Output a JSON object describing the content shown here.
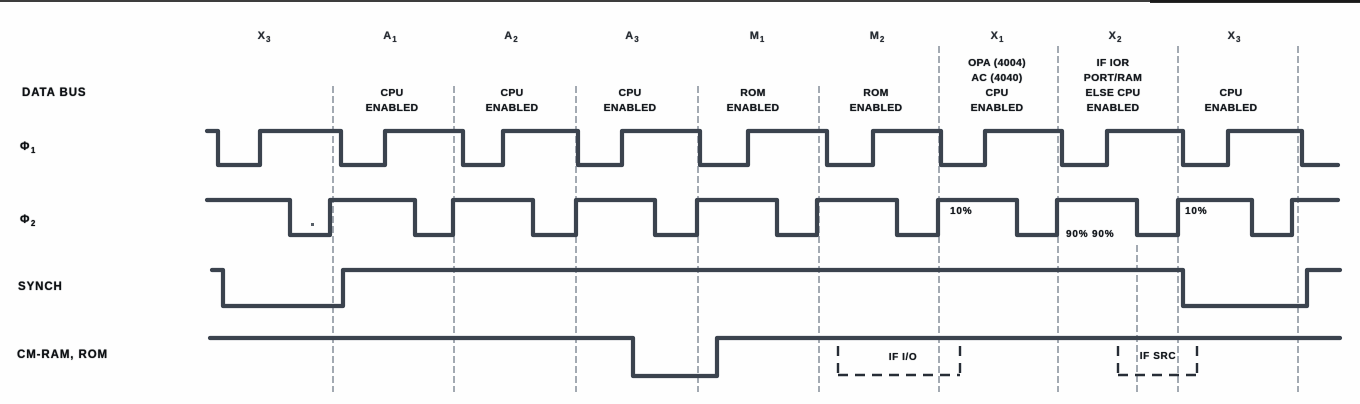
{
  "canvas": {
    "width": 1360,
    "height": 404
  },
  "colors": {
    "ink": "#3b434e",
    "grid": "#5c6878",
    "window": "#272d36",
    "text": "#14181d",
    "background": "#fefefe"
  },
  "phase_labels": [
    {
      "base": "X",
      "sub": "3",
      "x": 264,
      "y": 30
    },
    {
      "base": "A",
      "sub": "1",
      "x": 390,
      "y": 30
    },
    {
      "base": "A",
      "sub": "2",
      "x": 511,
      "y": 30
    },
    {
      "base": "A",
      "sub": "3",
      "x": 632,
      "y": 30
    },
    {
      "base": "M",
      "sub": "1",
      "x": 757,
      "y": 30
    },
    {
      "base": "M",
      "sub": "2",
      "x": 877,
      "y": 30
    },
    {
      "base": "X",
      "sub": "1",
      "x": 997,
      "y": 30
    },
    {
      "base": "X",
      "sub": "2",
      "x": 1115,
      "y": 30
    },
    {
      "base": "X",
      "sub": "3",
      "x": 1234,
      "y": 30
    }
  ],
  "row_labels": [
    {
      "name": "data-bus-label",
      "text": "DATA BUS",
      "x": 22,
      "y": 87
    },
    {
      "name": "phi1-label",
      "base": "Φ",
      "sub": "1",
      "x": 20,
      "y": 141
    },
    {
      "name": "phi2-label",
      "base": "Φ",
      "sub": "2",
      "x": 20,
      "y": 214
    },
    {
      "name": "synch-label",
      "text": "SYNCH",
      "x": 18,
      "y": 281
    },
    {
      "name": "cm-ram-rom-label",
      "text": "CM-RAM, ROM",
      "x": 17,
      "y": 349
    }
  ],
  "bus_annotations": [
    {
      "lines": [
        "CPU",
        "ENABLED"
      ],
      "x": 392,
      "y": 86
    },
    {
      "lines": [
        "CPU",
        "ENABLED"
      ],
      "x": 512,
      "y": 86
    },
    {
      "lines": [
        "CPU",
        "ENABLED"
      ],
      "x": 630,
      "y": 86
    },
    {
      "lines": [
        "ROM",
        "ENABLED"
      ],
      "x": 753,
      "y": 86
    },
    {
      "lines": [
        "ROM",
        "ENABLED"
      ],
      "x": 876,
      "y": 86
    },
    {
      "lines": [
        "OPA (4004)",
        "AC (4040)",
        "CPU",
        "ENABLED"
      ],
      "x": 997,
      "y": 56
    },
    {
      "lines": [
        "IF IOR",
        "PORT/RAM",
        "ELSE CPU",
        "ENABLED"
      ],
      "x": 1113,
      "y": 56
    },
    {
      "lines": [
        "CPU",
        "ENABLED"
      ],
      "x": 1231,
      "y": 86
    }
  ],
  "grid": {
    "y_bottom": 392,
    "lines": [
      {
        "x": 333,
        "y1": 86
      },
      {
        "x": 454,
        "y1": 86
      },
      {
        "x": 576,
        "y1": 86
      },
      {
        "x": 698,
        "y1": 86
      },
      {
        "x": 819,
        "y1": 86
      },
      {
        "x": 939,
        "y1": 46
      },
      {
        "x": 1058,
        "y1": 46
      },
      {
        "x": 1178,
        "y1": 46
      },
      {
        "x": 1298,
        "y1": 46
      }
    ],
    "short_line": {
      "x": 1137,
      "y1": 245,
      "y2": 392
    }
  },
  "signals": [
    {
      "id": "phi1",
      "high_y": 131,
      "low_y": 165,
      "points": [
        [
          207,
          "H"
        ],
        [
          218,
          "H"
        ],
        [
          218,
          "L"
        ],
        [
          260,
          "L"
        ],
        [
          260,
          "H"
        ],
        [
          341,
          "H"
        ],
        [
          341,
          "L"
        ],
        [
          385,
          "L"
        ],
        [
          385,
          "H"
        ],
        [
          463,
          "H"
        ],
        [
          463,
          "L"
        ],
        [
          503,
          "L"
        ],
        [
          503,
          "H"
        ],
        [
          578,
          "H"
        ],
        [
          578,
          "L"
        ],
        [
          622,
          "L"
        ],
        [
          622,
          "H"
        ],
        [
          700,
          "H"
        ],
        [
          700,
          "L"
        ],
        [
          748,
          "L"
        ],
        [
          748,
          "H"
        ],
        [
          827,
          "H"
        ],
        [
          827,
          "L"
        ],
        [
          873,
          "L"
        ],
        [
          873,
          "H"
        ],
        [
          941,
          "H"
        ],
        [
          941,
          "L"
        ],
        [
          985,
          "L"
        ],
        [
          985,
          "H"
        ],
        [
          1062,
          "H"
        ],
        [
          1062,
          "L"
        ],
        [
          1107,
          "L"
        ],
        [
          1107,
          "H"
        ],
        [
          1183,
          "H"
        ],
        [
          1183,
          "L"
        ],
        [
          1228,
          "L"
        ],
        [
          1228,
          "H"
        ],
        [
          1302,
          "H"
        ],
        [
          1302,
          "L"
        ],
        [
          1338,
          "L"
        ]
      ]
    },
    {
      "id": "phi2",
      "high_y": 200,
      "low_y": 235,
      "points": [
        [
          207,
          "H"
        ],
        [
          290,
          "H"
        ],
        [
          290,
          "L"
        ],
        [
          330,
          "L"
        ],
        [
          330,
          "H"
        ],
        [
          415,
          "H"
        ],
        [
          415,
          "L"
        ],
        [
          453,
          "L"
        ],
        [
          453,
          "H"
        ],
        [
          533,
          "H"
        ],
        [
          533,
          "L"
        ],
        [
          576,
          "L"
        ],
        [
          576,
          "H"
        ],
        [
          655,
          "H"
        ],
        [
          655,
          "L"
        ],
        [
          697,
          "L"
        ],
        [
          697,
          "H"
        ],
        [
          777,
          "H"
        ],
        [
          777,
          "L"
        ],
        [
          817,
          "L"
        ],
        [
          817,
          "H"
        ],
        [
          897,
          "H"
        ],
        [
          897,
          "L"
        ],
        [
          938,
          "L"
        ],
        [
          938,
          "H"
        ],
        [
          1017,
          "H"
        ],
        [
          1017,
          "L"
        ],
        [
          1057,
          "L"
        ],
        [
          1057,
          "H"
        ],
        [
          1137,
          "H"
        ],
        [
          1137,
          "L"
        ],
        [
          1178,
          "L"
        ],
        [
          1178,
          "H"
        ],
        [
          1252,
          "H"
        ],
        [
          1252,
          "L"
        ],
        [
          1292,
          "L"
        ],
        [
          1292,
          "H"
        ],
        [
          1338,
          "H"
        ]
      ]
    },
    {
      "id": "synch",
      "high_y": 270,
      "low_y": 306,
      "points": [
        [
          212,
          "H"
        ],
        [
          223,
          "H"
        ],
        [
          223,
          "L"
        ],
        [
          343,
          "L"
        ],
        [
          343,
          "H"
        ],
        [
          1183,
          "H"
        ],
        [
          1183,
          "L"
        ],
        [
          1307,
          "L"
        ],
        [
          1307,
          "H"
        ],
        [
          1340,
          "H"
        ]
      ]
    },
    {
      "id": "cm-ram-rom",
      "high_y": 338,
      "low_y": 376,
      "points": [
        [
          210,
          "H"
        ],
        [
          633,
          "H"
        ],
        [
          633,
          "L"
        ],
        [
          717,
          "L"
        ],
        [
          717,
          "H"
        ],
        [
          1340,
          "H"
        ]
      ]
    }
  ],
  "percent_labels": [
    {
      "text": "10%",
      "x": 950,
      "y": 206
    },
    {
      "text": "90% 90%",
      "x": 1066,
      "y": 229
    },
    {
      "text": "10%",
      "x": 1185,
      "y": 206
    }
  ],
  "dashed_windows": [
    {
      "label": "IF I/O",
      "x1": 838,
      "x2": 960,
      "y1": 346,
      "y2": 375,
      "label_x": 903,
      "label_y": 352
    },
    {
      "label": "IF SRC",
      "x1": 1118,
      "x2": 1197,
      "y1": 346,
      "y2": 375,
      "label_x": 1158,
      "label_y": 351
    }
  ],
  "specks": [
    {
      "x": 311,
      "y": 223,
      "w": 3,
      "h": 3
    }
  ]
}
